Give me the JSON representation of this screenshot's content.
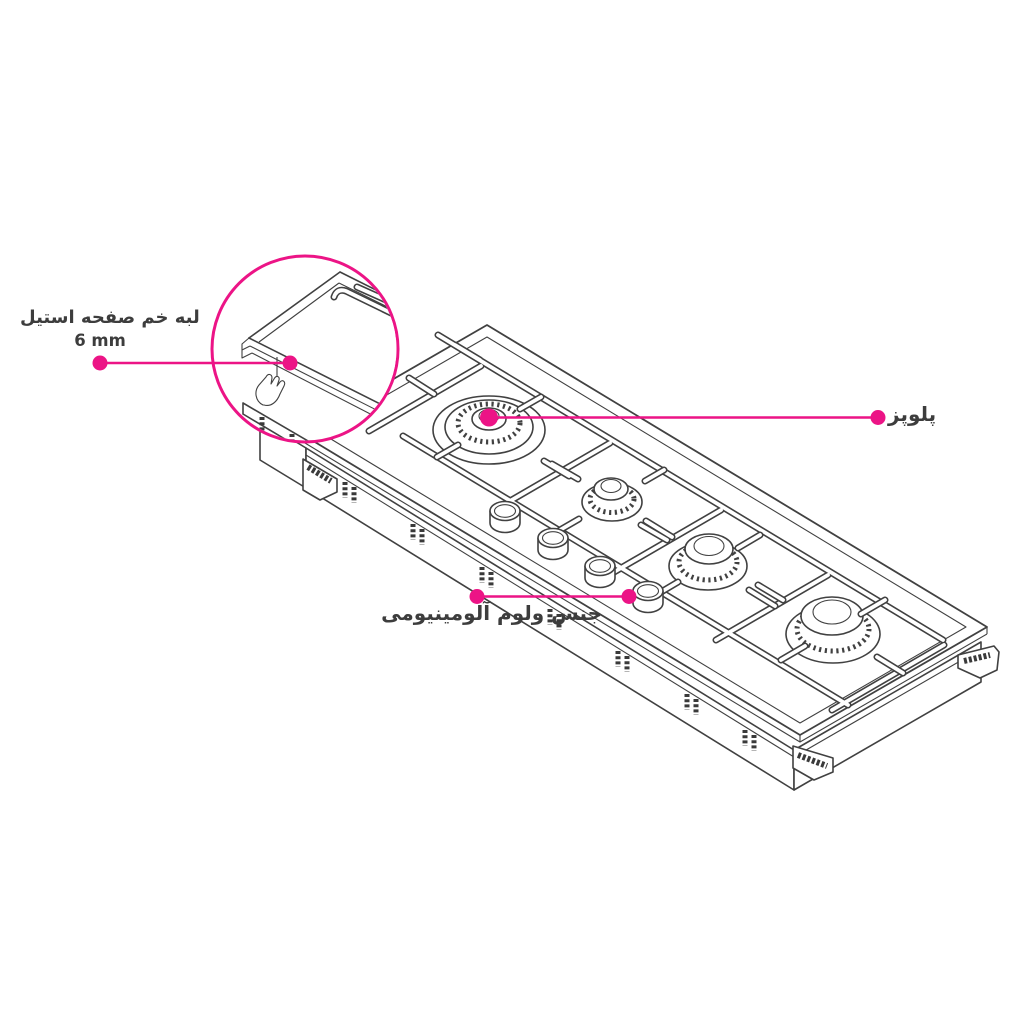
{
  "page": {
    "background": "#ffffff"
  },
  "colors": {
    "accent": "#EC1486",
    "line": "#414141",
    "text": "#3D3D3D"
  },
  "figure": {
    "kind": "gas-cooktop-isometric-line-drawing",
    "burner_count": 4,
    "knob_count": 4,
    "magnifier": "steel-edge-corner-detail"
  },
  "annotations": {
    "steel_edge": {
      "label": "لبه خم صفحه استیل",
      "value": "6 mm"
    },
    "main_burner": {
      "label": "پلوپز"
    },
    "knob_material": {
      "label": "جنس ولوم آلومینیومی"
    }
  }
}
